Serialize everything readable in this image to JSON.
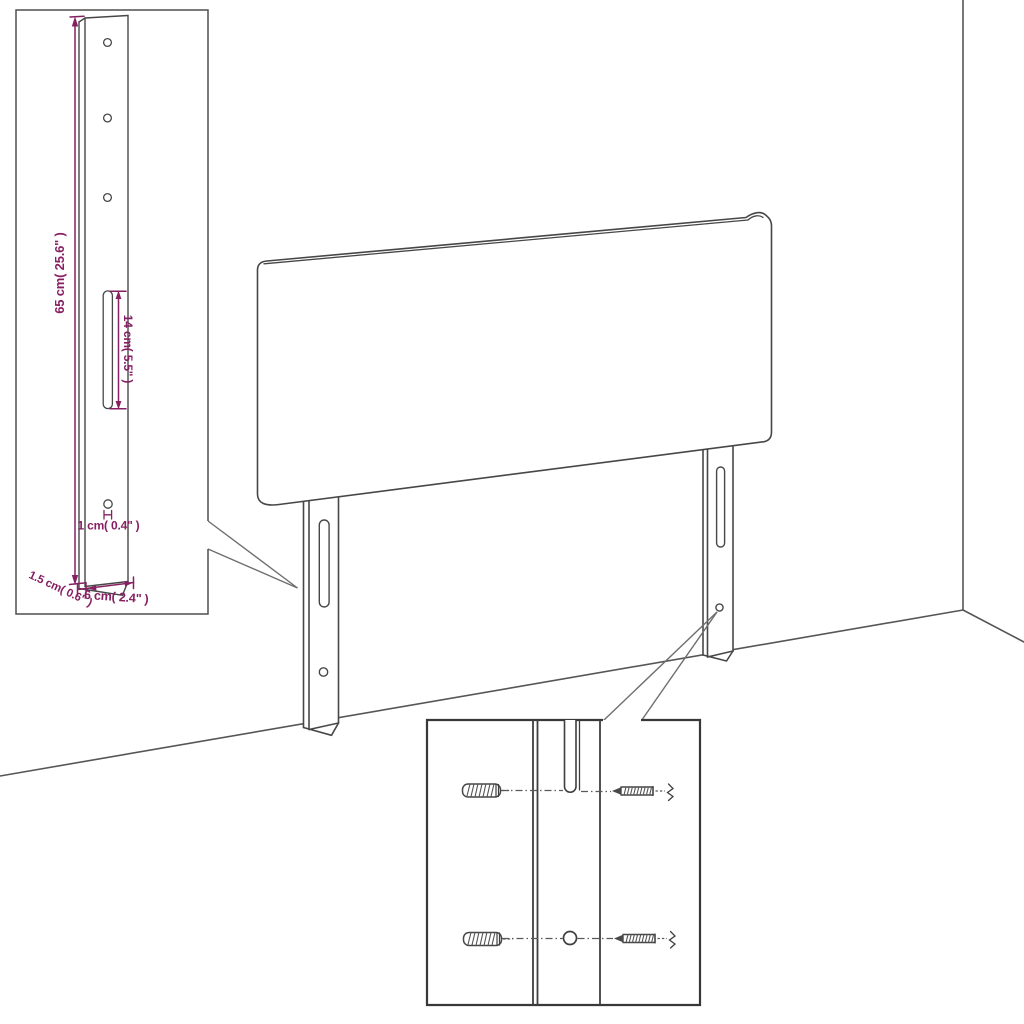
{
  "diagram": {
    "detail_leg": {
      "height_label": "65 cm( 25.6\" )",
      "slot_label": "14 cm( 5.5\" )",
      "hole_label": "1 cm( 0.4\" )",
      "thickness_label": "1.5 cm( 0.6\" )",
      "width_label": "6 cm( 2.4\" )"
    },
    "colors": {
      "dimension_accent": "#871f63",
      "outline": "#474747",
      "background": "#ffffff"
    }
  }
}
